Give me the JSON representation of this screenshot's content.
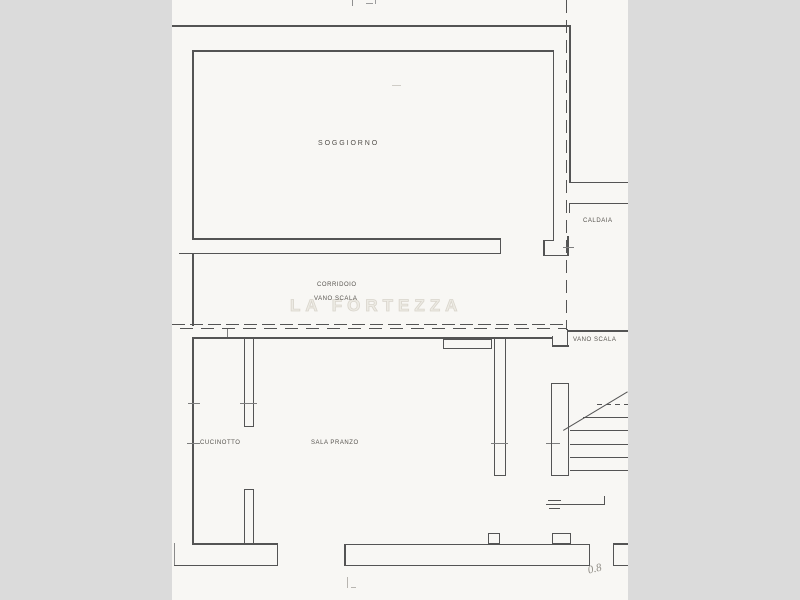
{
  "page": {
    "background": "#dbdbdb",
    "paper_color": "#f8f7f4",
    "paper_x": 172,
    "paper_width": 456
  },
  "rooms": {
    "soggiorno": "SOGGIORNO",
    "caldaia": "CALDAIA",
    "corridoio": "CORRIDOIO",
    "vano_scala_corridor": "VANO SCALA",
    "vano_scala_stair": "VANO SCALA",
    "cucinotto": "CUCINOTTO",
    "sala_pranzo": "SALA PRANZO"
  },
  "watermark": "LA FORTEZZA",
  "pencil_note": "0.8",
  "plan": {
    "line_color": "#545454",
    "tick_color": "#7d7d7d",
    "lines": [
      {
        "x": 565.5,
        "y": 0,
        "w": 1.3,
        "h": 330,
        "s": "dv"
      },
      {
        "x": 172,
        "y": 25,
        "w": 399,
        "h": 1.8
      },
      {
        "x": 569.2,
        "y": 25,
        "w": 1.8,
        "h": 158
      },
      {
        "x": 569,
        "y": 182,
        "w": 59,
        "h": 1.4
      },
      {
        "x": 569,
        "y": 203,
        "w": 59,
        "h": 1.4
      },
      {
        "x": 569,
        "y": 204,
        "w": 1.4,
        "h": 9
      },
      {
        "x": 192,
        "y": 50,
        "w": 362,
        "h": 1.5
      },
      {
        "x": 192,
        "y": 50,
        "w": 1.5,
        "h": 189
      },
      {
        "x": 552.5,
        "y": 50,
        "w": 1.5,
        "h": 190
      },
      {
        "x": 192,
        "y": 238,
        "w": 308,
        "h": 1.5
      },
      {
        "x": 179,
        "y": 252.5,
        "w": 322,
        "h": 1.5
      },
      {
        "x": 499.5,
        "y": 238,
        "w": 1.5,
        "h": 16
      },
      {
        "x": 543,
        "y": 239.5,
        "w": 11,
        "h": 1.5
      },
      {
        "x": 543,
        "y": 239.5,
        "w": 1.5,
        "h": 16.5
      },
      {
        "x": 543,
        "y": 254.5,
        "w": 25.5,
        "h": 1.5
      },
      {
        "x": 567,
        "y": 236,
        "w": 1.5,
        "h": 20
      },
      {
        "x": 563,
        "y": 246.5,
        "w": 11,
        "h": 1,
        "c": "#7d7d7d"
      },
      {
        "x": 192,
        "y": 253.5,
        "w": 1.5,
        "h": 72
      },
      {
        "x": 172,
        "y": 323.5,
        "w": 396,
        "h": 1.5,
        "s": "dh"
      },
      {
        "x": 172,
        "y": 327.5,
        "w": 394,
        "h": 1.5,
        "s": "dh2"
      },
      {
        "x": 227,
        "y": 329,
        "w": 1,
        "h": 8,
        "c": "#7d7d7d"
      },
      {
        "x": 551.5,
        "y": 336,
        "w": 1.5,
        "h": 11
      },
      {
        "x": 551.5,
        "y": 345,
        "w": 17,
        "h": 1.5
      },
      {
        "x": 566.5,
        "y": 329,
        "w": 1.5,
        "h": 17.5
      },
      {
        "x": 567,
        "y": 330,
        "w": 61,
        "h": 1.5
      },
      {
        "x": 192,
        "y": 337,
        "w": 361,
        "h": 1.8
      },
      {
        "x": 192,
        "y": 337,
        "w": 1.8,
        "h": 207
      },
      {
        "x": 243.5,
        "y": 338,
        "w": 1.4,
        "h": 89
      },
      {
        "x": 252.5,
        "y": 338,
        "w": 1.4,
        "h": 89
      },
      {
        "x": 243.5,
        "y": 426,
        "w": 10.4,
        "h": 1.4
      },
      {
        "x": 240,
        "y": 402.5,
        "w": 17,
        "h": 1,
        "c": "#7d7d7d"
      },
      {
        "x": 188,
        "y": 402.5,
        "w": 12,
        "h": 1,
        "c": "#7d7d7d"
      },
      {
        "x": 494,
        "y": 338,
        "w": 1.4,
        "h": 138
      },
      {
        "x": 504.5,
        "y": 338,
        "w": 1.4,
        "h": 138
      },
      {
        "x": 494,
        "y": 474.5,
        "w": 12,
        "h": 1.4
      },
      {
        "x": 491,
        "y": 442.5,
        "w": 17,
        "h": 1,
        "c": "#7d7d7d"
      },
      {
        "x": 187,
        "y": 442.5,
        "w": 13,
        "h": 1,
        "c": "#7d7d7d"
      },
      {
        "x": 546,
        "y": 442.5,
        "w": 14,
        "h": 1,
        "c": "#7d7d7d"
      },
      {
        "x": 597,
        "y": 404,
        "w": 31,
        "h": 1,
        "s": "dd"
      },
      {
        "x": 583,
        "y": 417,
        "w": 45,
        "h": 1
      },
      {
        "x": 570,
        "y": 430,
        "w": 58,
        "h": 1
      },
      {
        "x": 570,
        "y": 443.5,
        "w": 58,
        "h": 1
      },
      {
        "x": 570,
        "y": 456.5,
        "w": 58,
        "h": 1
      },
      {
        "x": 570,
        "y": 470,
        "w": 58,
        "h": 1
      },
      {
        "x": 548,
        "y": 500,
        "w": 13,
        "h": 1
      },
      {
        "x": 546,
        "y": 504,
        "w": 17,
        "h": 1
      },
      {
        "x": 549,
        "y": 508,
        "w": 11,
        "h": 1
      },
      {
        "x": 562,
        "y": 504,
        "w": 42,
        "h": 0.9
      },
      {
        "x": 603.5,
        "y": 496,
        "w": 0.9,
        "h": 8.5
      },
      {
        "x": 192,
        "y": 543,
        "w": 86,
        "h": 1.5
      },
      {
        "x": 276.5,
        "y": 543,
        "w": 1.5,
        "h": 23
      },
      {
        "x": 174,
        "y": 564.5,
        "w": 104,
        "h": 1.5
      },
      {
        "x": 174,
        "y": 543,
        "w": 1,
        "h": 22,
        "c": "#8a8a8a"
      },
      {
        "x": 344,
        "y": 543.5,
        "w": 246,
        "h": 1.6
      },
      {
        "x": 344,
        "y": 564.5,
        "w": 246,
        "h": 1.6
      },
      {
        "x": 344,
        "y": 543.5,
        "w": 1.6,
        "h": 22.5
      },
      {
        "x": 588.5,
        "y": 543.5,
        "w": 1.6,
        "h": 22.5
      },
      {
        "x": 612.5,
        "y": 543,
        "w": 1.5,
        "h": 23
      },
      {
        "x": 612.5,
        "y": 543,
        "w": 15.5,
        "h": 1.5
      },
      {
        "x": 612.5,
        "y": 564.5,
        "w": 15.5,
        "h": 1.5
      },
      {
        "x": 244,
        "y": 489,
        "w": 1.4,
        "h": 54
      },
      {
        "x": 253,
        "y": 489,
        "w": 1.4,
        "h": 54
      },
      {
        "x": 244,
        "y": 489,
        "w": 10.4,
        "h": 1.4
      },
      {
        "x": 352,
        "y": 0,
        "w": 1,
        "h": 6,
        "c": "#8f8f8f"
      },
      {
        "x": 366,
        "y": 3,
        "w": 7,
        "h": 1,
        "c": "#9c9c9c"
      },
      {
        "x": 374.5,
        "y": 0,
        "w": 1,
        "h": 4,
        "c": "#9c9c9c"
      },
      {
        "x": 392,
        "y": 85,
        "w": 9,
        "h": 1.2,
        "c": "#cfccc6"
      },
      {
        "x": 347,
        "y": 577,
        "w": 1,
        "h": 11,
        "c": "#b8b5b0"
      },
      {
        "x": 351,
        "y": 587,
        "w": 5,
        "h": 1,
        "c": "#b8b5b0"
      }
    ],
    "rects": [
      {
        "x": 443,
        "y": 339,
        "w": 49,
        "h": 10,
        "bw": 1
      },
      {
        "x": 551,
        "y": 383,
        "w": 18,
        "h": 93,
        "bw": 1.4
      },
      {
        "x": 488,
        "y": 533,
        "w": 12,
        "h": 11,
        "bw": 1.2
      },
      {
        "x": 552,
        "y": 533,
        "w": 19,
        "h": 11,
        "bw": 1.2
      }
    ],
    "diagonals": [
      {
        "x1": 563,
        "y1": 430,
        "x2": 627,
        "y2": 391.5,
        "t": 1
      }
    ]
  }
}
